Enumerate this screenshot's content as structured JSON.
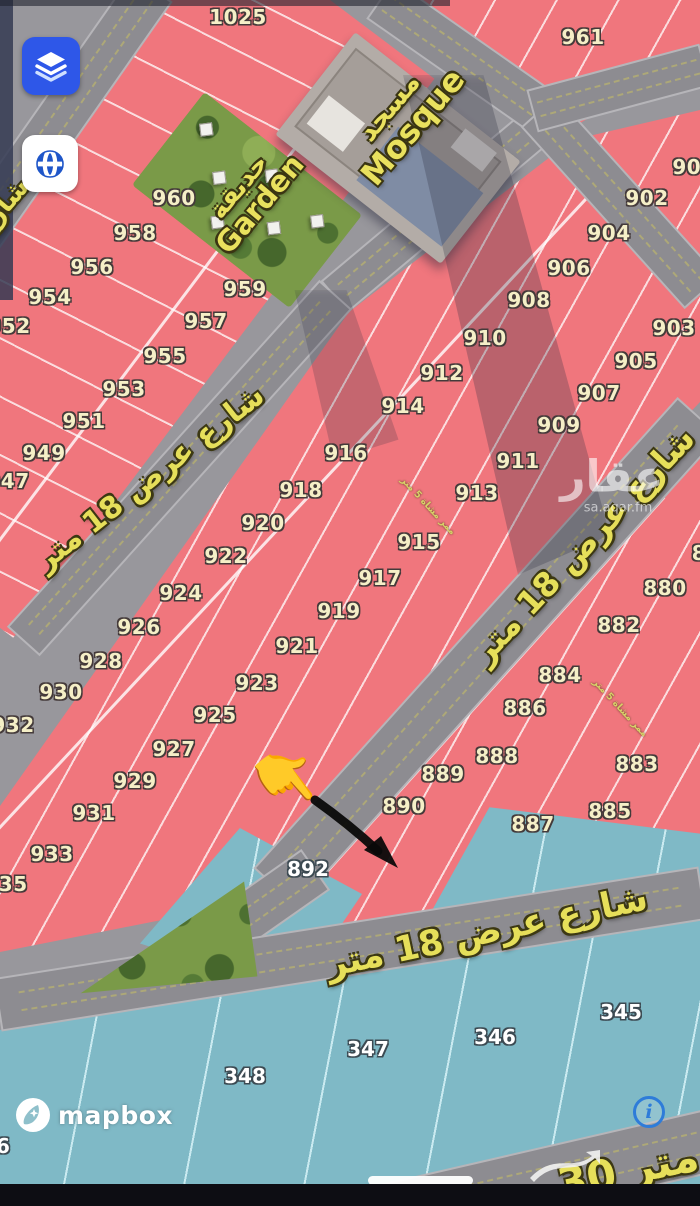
{
  "map": {
    "plot_labels_yellow": [
      {
        "t": "1025",
        "x": 238,
        "y": 17
      },
      {
        "t": "961",
        "x": 583,
        "y": 37
      },
      {
        "t": "900",
        "x": 694,
        "y": 167
      },
      {
        "t": "902",
        "x": 647,
        "y": 198
      },
      {
        "t": "904",
        "x": 609,
        "y": 233
      },
      {
        "t": "906",
        "x": 569,
        "y": 268
      },
      {
        "t": "908",
        "x": 529,
        "y": 300
      },
      {
        "t": "910",
        "x": 485,
        "y": 338
      },
      {
        "t": "912",
        "x": 442,
        "y": 373
      },
      {
        "t": "914",
        "x": 403,
        "y": 406
      },
      {
        "t": "916",
        "x": 346,
        "y": 453
      },
      {
        "t": "918",
        "x": 301,
        "y": 490
      },
      {
        "t": "920",
        "x": 263,
        "y": 523
      },
      {
        "t": "922",
        "x": 226,
        "y": 556
      },
      {
        "t": "924",
        "x": 181,
        "y": 593
      },
      {
        "t": "926",
        "x": 139,
        "y": 627
      },
      {
        "t": "928",
        "x": 101,
        "y": 661
      },
      {
        "t": "930",
        "x": 61,
        "y": 692
      },
      {
        "t": "932",
        "x": 13,
        "y": 725
      },
      {
        "t": "960",
        "x": 174,
        "y": 198
      },
      {
        "t": "958",
        "x": 135,
        "y": 233
      },
      {
        "t": "956",
        "x": 92,
        "y": 267
      },
      {
        "t": "954",
        "x": 50,
        "y": 297
      },
      {
        "t": "952",
        "x": 9,
        "y": 326
      },
      {
        "t": "959",
        "x": 245,
        "y": 289
      },
      {
        "t": "957",
        "x": 206,
        "y": 321
      },
      {
        "t": "955",
        "x": 165,
        "y": 356
      },
      {
        "t": "953",
        "x": 124,
        "y": 389
      },
      {
        "t": "951",
        "x": 84,
        "y": 421
      },
      {
        "t": "949",
        "x": 44,
        "y": 453
      },
      {
        "t": "947",
        "x": 8,
        "y": 481
      },
      {
        "t": "903",
        "x": 674,
        "y": 328
      },
      {
        "t": "905",
        "x": 636,
        "y": 361
      },
      {
        "t": "907",
        "x": 599,
        "y": 393
      },
      {
        "t": "909",
        "x": 559,
        "y": 425
      },
      {
        "t": "911",
        "x": 518,
        "y": 461
      },
      {
        "t": "913",
        "x": 477,
        "y": 493
      },
      {
        "t": "915",
        "x": 419,
        "y": 542
      },
      {
        "t": "917",
        "x": 380,
        "y": 578
      },
      {
        "t": "919",
        "x": 339,
        "y": 611
      },
      {
        "t": "921",
        "x": 297,
        "y": 646
      },
      {
        "t": "923",
        "x": 257,
        "y": 683
      },
      {
        "t": "925",
        "x": 215,
        "y": 715
      },
      {
        "t": "927",
        "x": 174,
        "y": 749
      },
      {
        "t": "929",
        "x": 135,
        "y": 781
      },
      {
        "t": "931",
        "x": 94,
        "y": 813
      },
      {
        "t": "933",
        "x": 52,
        "y": 854
      },
      {
        "t": "935",
        "x": 6,
        "y": 884
      },
      {
        "t": "880",
        "x": 665,
        "y": 588
      },
      {
        "t": "882",
        "x": 619,
        "y": 625
      },
      {
        "t": "884",
        "x": 560,
        "y": 675
      },
      {
        "t": "886",
        "x": 525,
        "y": 708
      },
      {
        "t": "888",
        "x": 497,
        "y": 756
      },
      {
        "t": "889",
        "x": 443,
        "y": 774
      },
      {
        "t": "890",
        "x": 404,
        "y": 806
      },
      {
        "t": "883",
        "x": 637,
        "y": 764
      },
      {
        "t": "885",
        "x": 610,
        "y": 811
      },
      {
        "t": "887",
        "x": 533,
        "y": 824
      },
      {
        "t": "8",
        "x": 699,
        "y": 553
      }
    ],
    "plot_labels_white": [
      {
        "t": "892",
        "x": 308,
        "y": 869
      },
      {
        "t": "345",
        "x": 621,
        "y": 1012
      },
      {
        "t": "346",
        "x": 495,
        "y": 1037
      },
      {
        "t": "347",
        "x": 368,
        "y": 1049
      },
      {
        "t": "348",
        "x": 245,
        "y": 1076
      },
      {
        "t": "6",
        "x": 3,
        "y": 1146
      }
    ],
    "street_labels": [
      {
        "t": "شارع عرض 18 متر",
        "x": 150,
        "y": 478,
        "rot": -38,
        "size": 30
      },
      {
        "t": "شارع عرض 18 متر",
        "x": 583,
        "y": 545,
        "rot": -47,
        "size": 33
      },
      {
        "t": "شارع عرض 18 متر",
        "x": 487,
        "y": 932,
        "rot": -12,
        "size": 35
      },
      {
        "t": "30 متر",
        "x": 628,
        "y": 1170,
        "rot": -12,
        "size": 42
      },
      {
        "t": "شارع",
        "x": 2,
        "y": 208,
        "rot": -50,
        "size": 26
      }
    ],
    "path_labels": [
      {
        "t": "ممر مشاة 5 متر",
        "x": 428,
        "y": 506,
        "rot": 47
      },
      {
        "t": "ممر مشاة 5 متر",
        "x": 620,
        "y": 708,
        "rot": 47
      }
    ],
    "pois": {
      "mosque_ar": "مسجد",
      "mosque_en": "Mosque",
      "garden_ar": "حديقة",
      "garden_en": "Garden"
    },
    "watermark": {
      "name": "عقار",
      "site": "sa.aqar.fm"
    },
    "attribution": {
      "brand": "mapbox"
    },
    "pointer_emoji": "👇"
  },
  "controls": {
    "layers_button": "layers-icon",
    "globe_button": "globe-icon",
    "info_button": "i"
  },
  "colors": {
    "plot_pink": "#f0767d",
    "plot_blue": "#7fb9c6",
    "road_gray": "#8d8c91",
    "accent_blue": "#2e57e8",
    "street_text": "#e6df5a",
    "plot_number": "#f5efc7",
    "info_blue": "#2e7cd9",
    "garden_green": "#7a9a48"
  }
}
